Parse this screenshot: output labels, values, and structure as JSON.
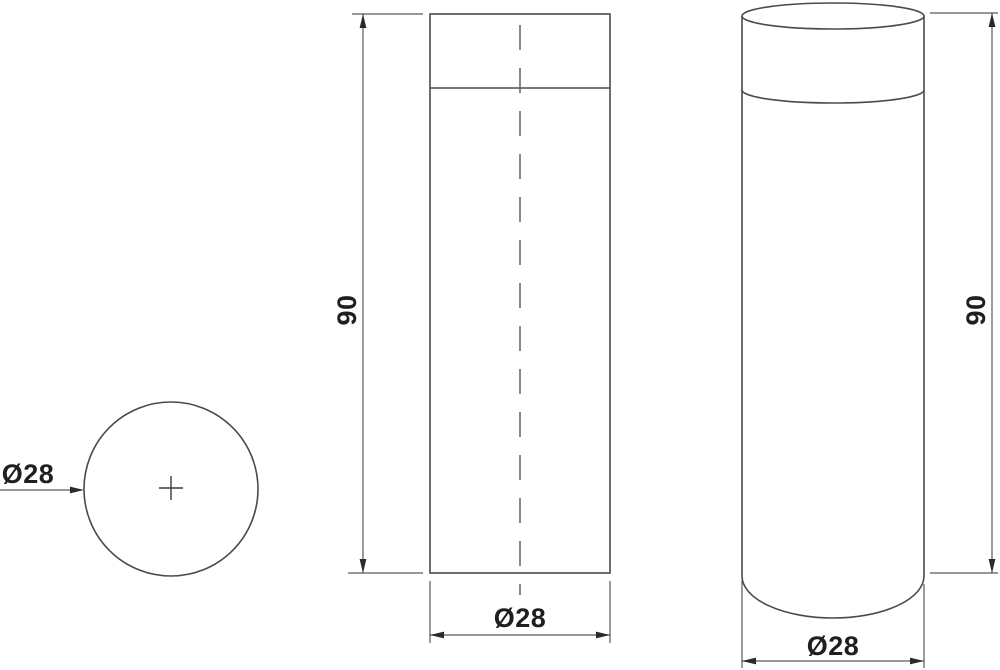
{
  "drawing": {
    "background_color": "#ffffff",
    "outline_color": "#4a4a4a",
    "dimension_line_color": "#5a5a5a",
    "text_color": "#1f1f1f",
    "views": {
      "top": {
        "diameter_label": "Ø28"
      },
      "front": {
        "height_label": "90",
        "diameter_label": "Ø28"
      },
      "perspective": {
        "height_label": "90",
        "diameter_label": "Ø28"
      }
    }
  }
}
